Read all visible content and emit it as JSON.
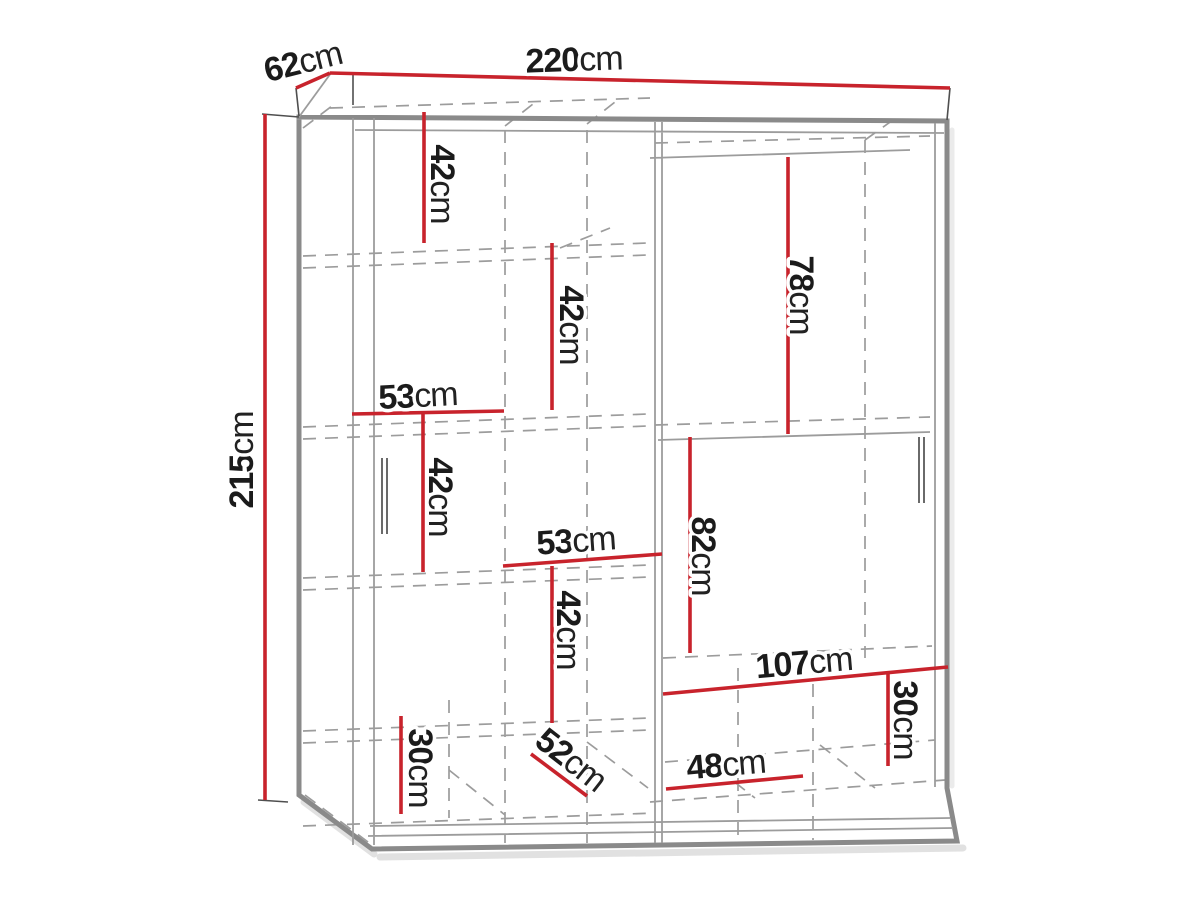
{
  "diagram": {
    "subject": "wardrobe-dimension-drawing",
    "unit": "cm"
  },
  "labels": {
    "width_top": {
      "value": "220",
      "unit": "cm"
    },
    "depth_top": {
      "value": "62",
      "unit": "cm"
    },
    "height_left": {
      "value": "215",
      "unit": "cm"
    },
    "left_comp_1": {
      "value": "42",
      "unit": "cm"
    },
    "left_comp_2": {
      "value": "42",
      "unit": "cm"
    },
    "left_col_width_upper": {
      "value": "53",
      "unit": "cm"
    },
    "left_comp_3": {
      "value": "42",
      "unit": "cm"
    },
    "left_col_width_lower": {
      "value": "53",
      "unit": "cm"
    },
    "left_comp_4": {
      "value": "42",
      "unit": "cm"
    },
    "right_hang_upper": {
      "value": "78",
      "unit": "cm"
    },
    "right_hang_lower": {
      "value": "82",
      "unit": "cm"
    },
    "right_shelf_width": {
      "value": "107",
      "unit": "cm"
    },
    "right_bottom_height": {
      "value": "30",
      "unit": "cm"
    },
    "bottom_shelf_width": {
      "value": "48",
      "unit": "cm"
    },
    "left_bottom_height": {
      "value": "30",
      "unit": "cm"
    },
    "interior_depth": {
      "value": "52",
      "unit": "cm"
    }
  },
  "colors": {
    "dimension_red": "#c8232c",
    "frame_gray": "#8a8a8a",
    "dashed_gray": "#9c9c9c",
    "text_black": "#1b1b1b",
    "background": "#ffffff"
  }
}
